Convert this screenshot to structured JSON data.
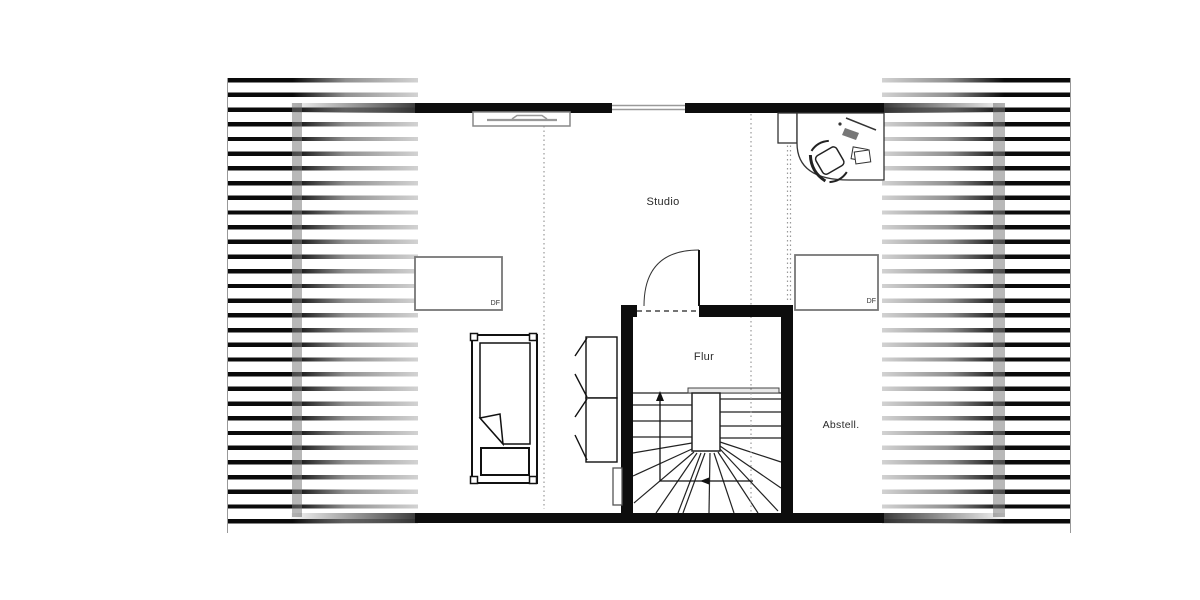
{
  "rooms": [
    {
      "id": "studio",
      "label": "Studio"
    },
    {
      "id": "flur",
      "label": "Flur"
    },
    {
      "id": "abstell",
      "label": "Abstell."
    }
  ],
  "roof_windows": [
    {
      "id": "df-left",
      "label": "DF"
    },
    {
      "id": "df-right",
      "label": "DF"
    }
  ],
  "colors": {
    "wall": "#0d0d0d",
    "line": "#111111",
    "gray_line": "#999999",
    "roof_band": "rgba(125,125,125,0.55)",
    "background": "#ffffff"
  }
}
